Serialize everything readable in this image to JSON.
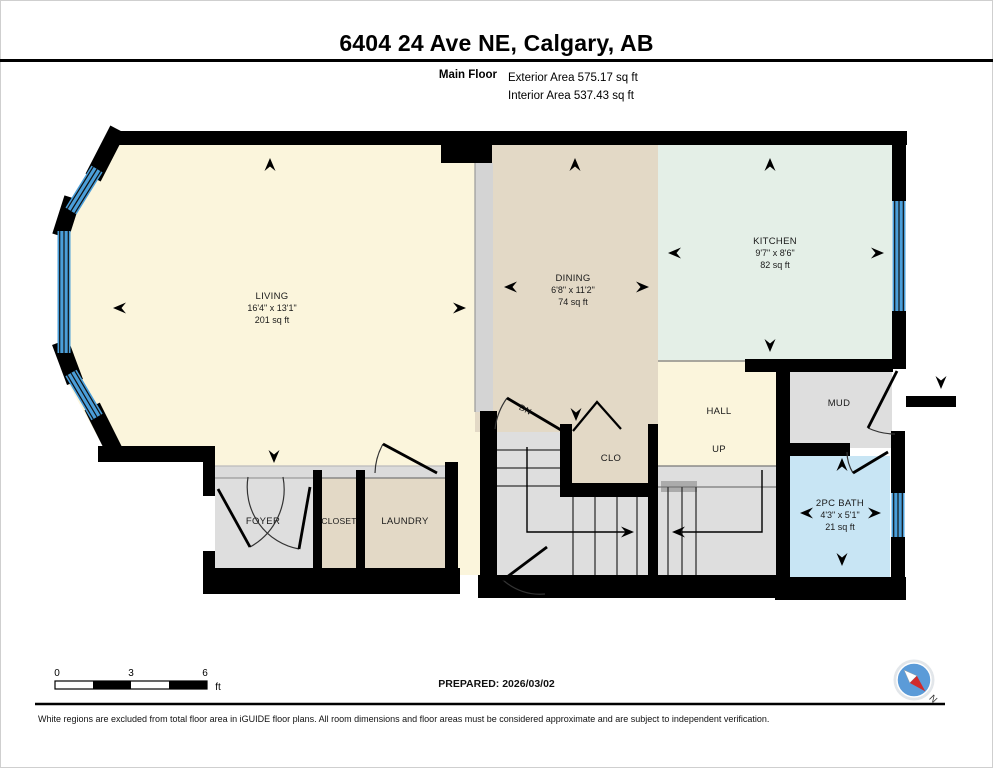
{
  "header": {
    "title": "6404 24 Ave NE, Calgary, AB",
    "floor_label": "Main Floor",
    "exterior_area": "Exterior Area 575.17 sq ft",
    "interior_area": "Interior Area 537.43 sq ft"
  },
  "rooms": {
    "living": {
      "name": "LIVING",
      "dims": "16'4\" x 13'1\"",
      "area": "201 sq ft"
    },
    "dining": {
      "name": "DINING",
      "dims": "6'8\" x 11'2\"",
      "area": "74 sq ft"
    },
    "kitchen": {
      "name": "KITCHEN",
      "dims": "9'7\" x 8'6\"",
      "area": "82 sq ft"
    },
    "bath": {
      "name": "2PC BATH",
      "dims": "4'3\" x 5'1\"",
      "area": "21 sq ft"
    },
    "hall": {
      "name": "HALL"
    },
    "mud": {
      "name": "MUD"
    },
    "clo": {
      "name": "CLO"
    },
    "foyer": {
      "name": "FOYER"
    },
    "closet": {
      "name": "CLOSET"
    },
    "laundry": {
      "name": "LAUNDRY"
    },
    "up_label": "UP",
    "dn_label": "DN"
  },
  "footer": {
    "scale": {
      "tick0": "0",
      "tick3": "3",
      "tick6": "6",
      "unit": "ft"
    },
    "prepared": "PREPARED: 2026/03/02",
    "compass_label": "N",
    "disclaimer": "White regions are excluded from total floor area in iGUIDE floor plans. All room dimensions and floor areas must be considered approximate and are subject to independent verification."
  },
  "colors": {
    "wall": "#000000",
    "living_floor": "#FBF5DC",
    "dining_floor": "#E3D9C6",
    "kitchen_floor": "#E4EFE7",
    "gray_floor": "#DEDEDE",
    "bath_floor": "#C8E5F4",
    "window_blue": "#4A9ED9",
    "divider_gray": "#D4D4D4",
    "compass_blue": "#5B9BD8",
    "compass_red": "#D22B2B"
  }
}
